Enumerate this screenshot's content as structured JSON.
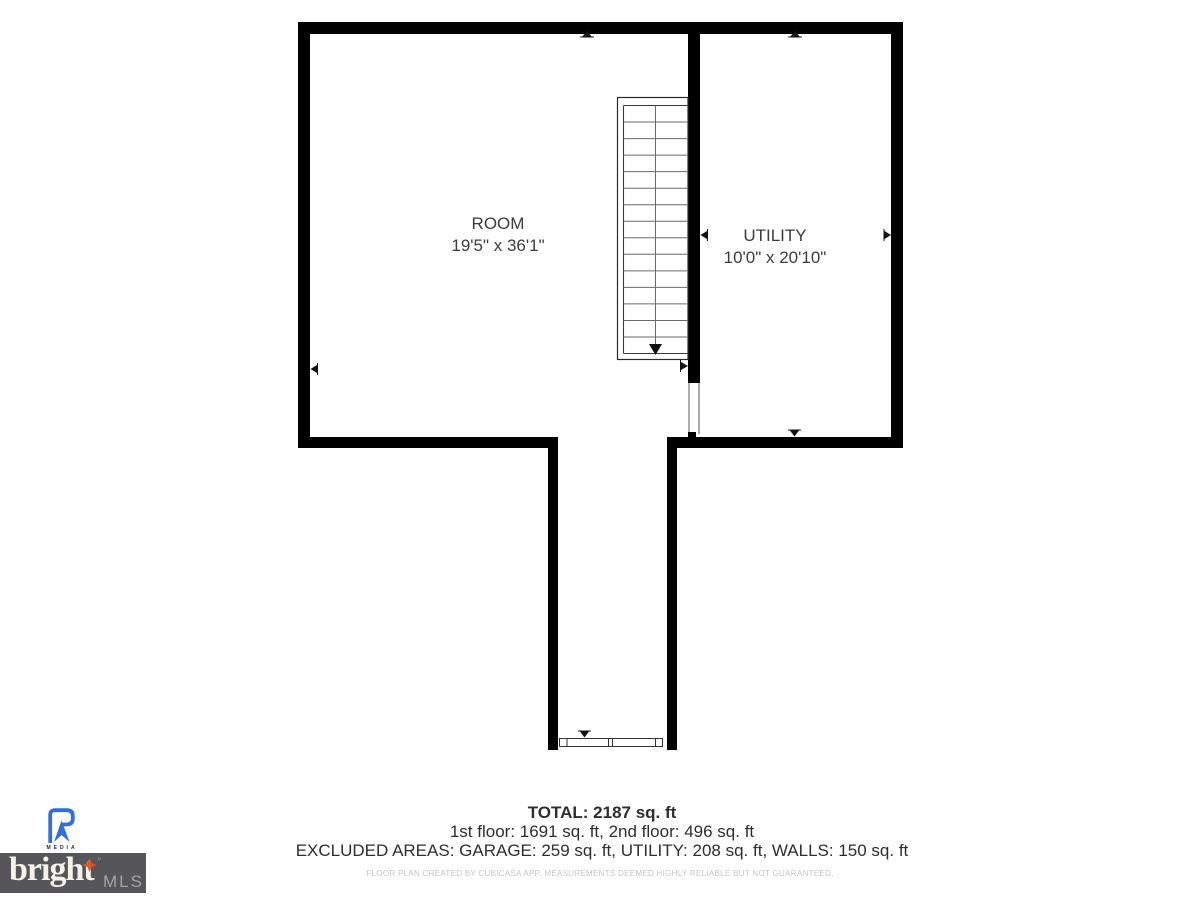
{
  "plan": {
    "rooms": [
      {
        "name": "ROOM",
        "dimensions": "19'5\" x 36'1\""
      },
      {
        "name": "UTILITY",
        "dimensions": "10'0\" x 20'10\""
      }
    ],
    "features": [
      "staircase-down",
      "door-opening-divider",
      "corridor-entry-door"
    ]
  },
  "summary": {
    "total": "TOTAL: 2187 sq. ft",
    "floors": "1st floor: 1691 sq. ft, 2nd floor: 496 sq. ft",
    "excluded": "EXCLUDED AREAS: GARAGE: 259 sq. ft, UTILITY: 208 sq. ft, WALLS: 150 sq. ft"
  },
  "disclaimer": "FLOOR PLAN CREATED BY CUBICASA APP. MEASUREMENTS DEEMED HIGHLY RELIABLE BUT NOT GUARANTEED.",
  "branding": {
    "rmedia_label": "MEDIA",
    "bright_word": "bright",
    "quote_mark": "″",
    "mls_word": "MLS"
  },
  "colors": {
    "wall": "#000000",
    "stair_line": "#6a6a6a",
    "label_text": "#3c3c3c",
    "summary_text": "#2e2e2e",
    "disclaimer_text": "#c5c5c5",
    "rmedia_blue": "#2f6fe0",
    "bright_box_gray": "#55555a",
    "bright_cream": "#f6f1e6",
    "bright_accent_orange": "#e0542a",
    "mls_gray": "#a3a3a8"
  }
}
